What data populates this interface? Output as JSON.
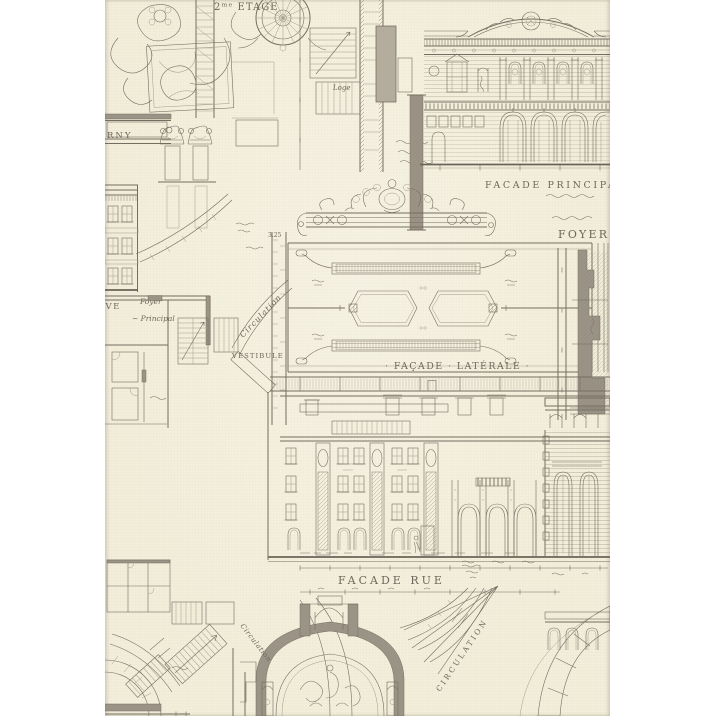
{
  "labels": {
    "etage": "2ᵐᵉ ETAGE",
    "rny_fragment": "RNY",
    "loge": "Loge",
    "facade_principale": "FACADE   PRINCIPALE",
    "foyer_caption": "FOYER",
    "dim_3_25": "3.25",
    "facade_laterale": "· FAÇADE · LATÉRALE ·",
    "circulation_script": "Circulation",
    "vestibule": "VESTIBULE",
    "ve_fragment": "VE",
    "foyer_script": "Foyer",
    "principal_script": "~ Principal",
    "facade_rue": "FACADE  RUE",
    "circulation_arc": "CIRCULATION",
    "circulation_script_2": "Circulation"
  },
  "colors": {
    "page_background": "#ffffff",
    "fabric_cream": "#f3eeda",
    "ink": "#746d61",
    "poche_gray": "#9b9386"
  }
}
